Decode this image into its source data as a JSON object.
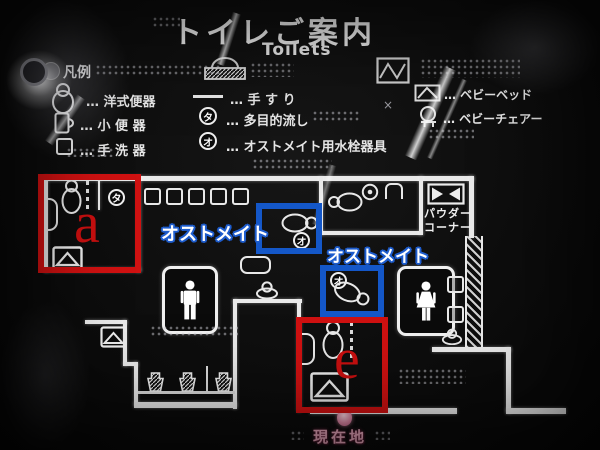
{
  "colors": {
    "annotation_red": "#cf1111",
    "annotation_blue": "#1457c8",
    "marker_pink": "#eba9be",
    "wall_white": "#e9e9e9"
  },
  "header": {
    "title": "トイレご案内",
    "subtitle": "Toilets"
  },
  "legend": {
    "heading": "凡例",
    "cross": "×",
    "col1": [
      {
        "icon": "western-toilet-icon",
        "label": "… 洋式便器"
      },
      {
        "icon": "urinal-icon",
        "label": "… 小 便 器"
      },
      {
        "icon": "washbasin-icon",
        "label": "… 手 洗 器"
      }
    ],
    "col2": [
      {
        "icon": "handrail-icon",
        "label": "… 手 す り"
      },
      {
        "symbol": "タ",
        "label": "… 多目的流し"
      },
      {
        "symbol": "オ",
        "label": "… オストメイト用水栓器具"
      }
    ],
    "col3": [
      {
        "icon": "baby-bed-icon",
        "label": "… ベビーベッド"
      },
      {
        "icon": "baby-chair-icon",
        "label": "… ベビーチェアー"
      }
    ]
  },
  "map": {
    "powder_corner": {
      "line1": "パウダー",
      "line2": "コーナー"
    },
    "ostomate_label_1": "オストメイト",
    "ostomate_label_2": "オストメイト",
    "symbol_ta": "タ",
    "symbol_o": "オ",
    "current_location": "現在地"
  },
  "annotations": {
    "box_a_letter": "a",
    "box_e_letter": "e"
  }
}
